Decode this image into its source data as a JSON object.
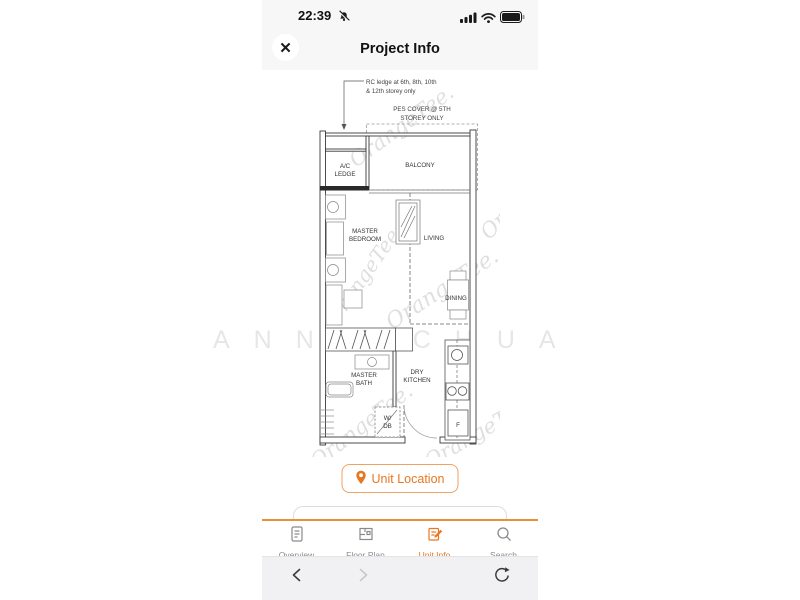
{
  "status_bar": {
    "time": "22:39",
    "icons": {
      "bell": "bell-slash",
      "signal": "cellular-signal",
      "wifi": "wifi",
      "battery": "battery-full"
    }
  },
  "header": {
    "title": "Project Info",
    "close_icon": "✕"
  },
  "floorplan": {
    "annotations": {
      "rc_ledge": [
        "RC ledge at 6th, 8th, 10th",
        "& 12th storey only"
      ],
      "pes_cover": [
        "PES COVER @ 5TH",
        "STOREY ONLY"
      ]
    },
    "rooms": {
      "ac_ledge": [
        "A/C",
        "LEDGE"
      ],
      "balcony": [
        "BALCONY"
      ],
      "master_bedroom": [
        "MASTER",
        "BEDROOM"
      ],
      "living": [
        "LIVING"
      ],
      "dining": [
        "DINING"
      ],
      "master_bath": [
        "MASTER",
        "BATH"
      ],
      "dry_kitchen": [
        "DRY",
        "KITCHEN"
      ],
      "wd_db": [
        "W/",
        "DB"
      ],
      "fridge": [
        "F"
      ]
    }
  },
  "watermarks": {
    "brand": "OrangeTee.",
    "agent": "ANN CHUA"
  },
  "unit_location": {
    "label": "Unit Location",
    "icon": "location-pin"
  },
  "tab_bar": {
    "tabs": [
      {
        "label": "Overview",
        "icon": "document-icon",
        "active": false
      },
      {
        "label": "Floor Plan",
        "icon": "floorplan-icon",
        "active": false
      },
      {
        "label": "Unit Info",
        "icon": "edit-document-icon",
        "active": true
      },
      {
        "label": "Search",
        "icon": "search-icon",
        "active": false
      }
    ]
  },
  "browser_bar": {
    "icons": [
      "back-chevron",
      "forward-chevron",
      "reload"
    ]
  },
  "colors": {
    "accent_orange": "#E87722",
    "divider_orange": "#E8913A",
    "button_border": "#F0A262",
    "tab_inactive": "#8A8A8E",
    "header_bg": "#F7F7F8",
    "browser_bar_bg": "#F1F1F3",
    "watermark_gray": "#C9C9CE"
  }
}
